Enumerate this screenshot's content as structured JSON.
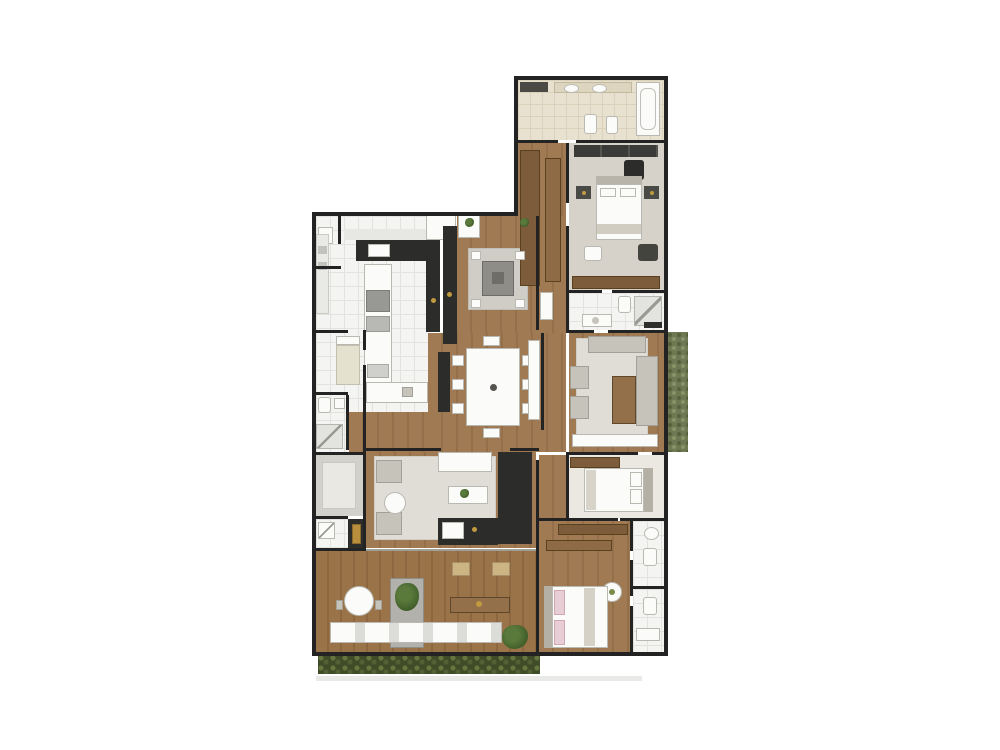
{
  "meta": {
    "description": "Top-down rendered architectural floor plan of a large apartment, centered on a white background. No visible text labels in the image.",
    "visible_text": []
  },
  "palette": {
    "wall": "#232323",
    "wood-a": "#a07a52",
    "wood-b": "#93704a",
    "deck-a": "#9b7348",
    "deck-b": "#8c6740",
    "tile": "#f4f4f2",
    "tile-line": "#e2e2de",
    "beige": "#e8e1cf",
    "beige-line": "#d9d1ba",
    "carpet": "#d6d2c9",
    "light": "#eae8e1",
    "rug": "#dfddd5",
    "dark": "#2c2c2a",
    "white": "#fbfbfa",
    "gold": "#c09a3e",
    "pink": "#e9cdd6",
    "hedge-green": "#3f4c28",
    "planter-green": "#6e7852"
  },
  "rooms": {
    "master_bathroom": {
      "name": "Master bathroom",
      "furniture": [
        "double vanity with two sinks",
        "toilet",
        "bidet",
        "bathtub"
      ]
    },
    "walk_in_closet": {
      "name": "Walk-in closet",
      "furniture": [
        "wardrobe run",
        "wardrobe run",
        "shelf unit"
      ]
    },
    "master_bedroom": {
      "name": "Master bedroom",
      "furniture": [
        "wardrobe",
        "double bed",
        "nightstands",
        "desk with chair",
        "pouf",
        "armchair",
        "low cabinet"
      ]
    },
    "suite2_bathroom": {
      "name": "Suite bathroom",
      "furniture": [
        "shower",
        "vanity",
        "toilet"
      ]
    },
    "sitting_room": {
      "name": "Sitting room",
      "furniture": [
        "sofa",
        "chaise",
        "two armchairs",
        "coffee table",
        "console"
      ]
    },
    "suite2_bedroom": {
      "name": "Second suite bedroom",
      "furniture": [
        "wardrobe",
        "double bed"
      ]
    },
    "suite3_bedroom": {
      "name": "Third suite bedroom",
      "furniture": [
        "wardrobes",
        "bed with pink pillows",
        "plant"
      ]
    },
    "bathroom_a": {
      "name": "Bathroom",
      "furniture": [
        "sink",
        "toilet"
      ]
    },
    "bathroom_b": {
      "name": "Bathroom",
      "furniture": [
        "toilet",
        "vanity"
      ]
    },
    "kitchen": {
      "name": "Kitchen",
      "furniture": [
        "L-shaped black counter",
        "cooktop",
        "island with oven",
        "counters",
        "pantry cabinets"
      ]
    },
    "laundry": {
      "name": "Laundry",
      "furniture": [
        "laundry sink"
      ]
    },
    "maid_room": {
      "name": "Service room",
      "furniture": [
        "single bed"
      ]
    },
    "maid_bathroom": {
      "name": "Service bathroom",
      "furniture": [
        "toilet",
        "sink",
        "shower"
      ]
    },
    "foyer": {
      "name": "Foyer",
      "furniture": [
        "square game table with four chairs",
        "tall black cabinet",
        "plants"
      ]
    },
    "dining_room": {
      "name": "Dining room",
      "furniture": [
        "dining table with eight chairs",
        "black buffet",
        "white sideboard"
      ]
    },
    "tv_room": {
      "name": "TV room",
      "furniture": [
        "sofa",
        "two armchairs",
        "round side table",
        "coffee table with plant",
        "media wall",
        "bar with sink"
      ]
    },
    "elevator_hall": {
      "name": "Private hall",
      "furniture": [
        "floor mat"
      ]
    },
    "powder_room": {
      "name": "Powder room",
      "furniture": [
        "corner basin"
      ]
    },
    "hallway": {
      "name": "Hallway",
      "furniture": []
    },
    "terrace": {
      "name": "Gourmet terrace",
      "furniture": [
        "round table",
        "flower planter",
        "dining table with two chairs",
        "long counter",
        "potted plants"
      ]
    },
    "hedge": {
      "name": "Perimeter hedge",
      "furniture": []
    },
    "vertical_garden": {
      "name": "Vertical garden planter",
      "furniture": []
    }
  }
}
